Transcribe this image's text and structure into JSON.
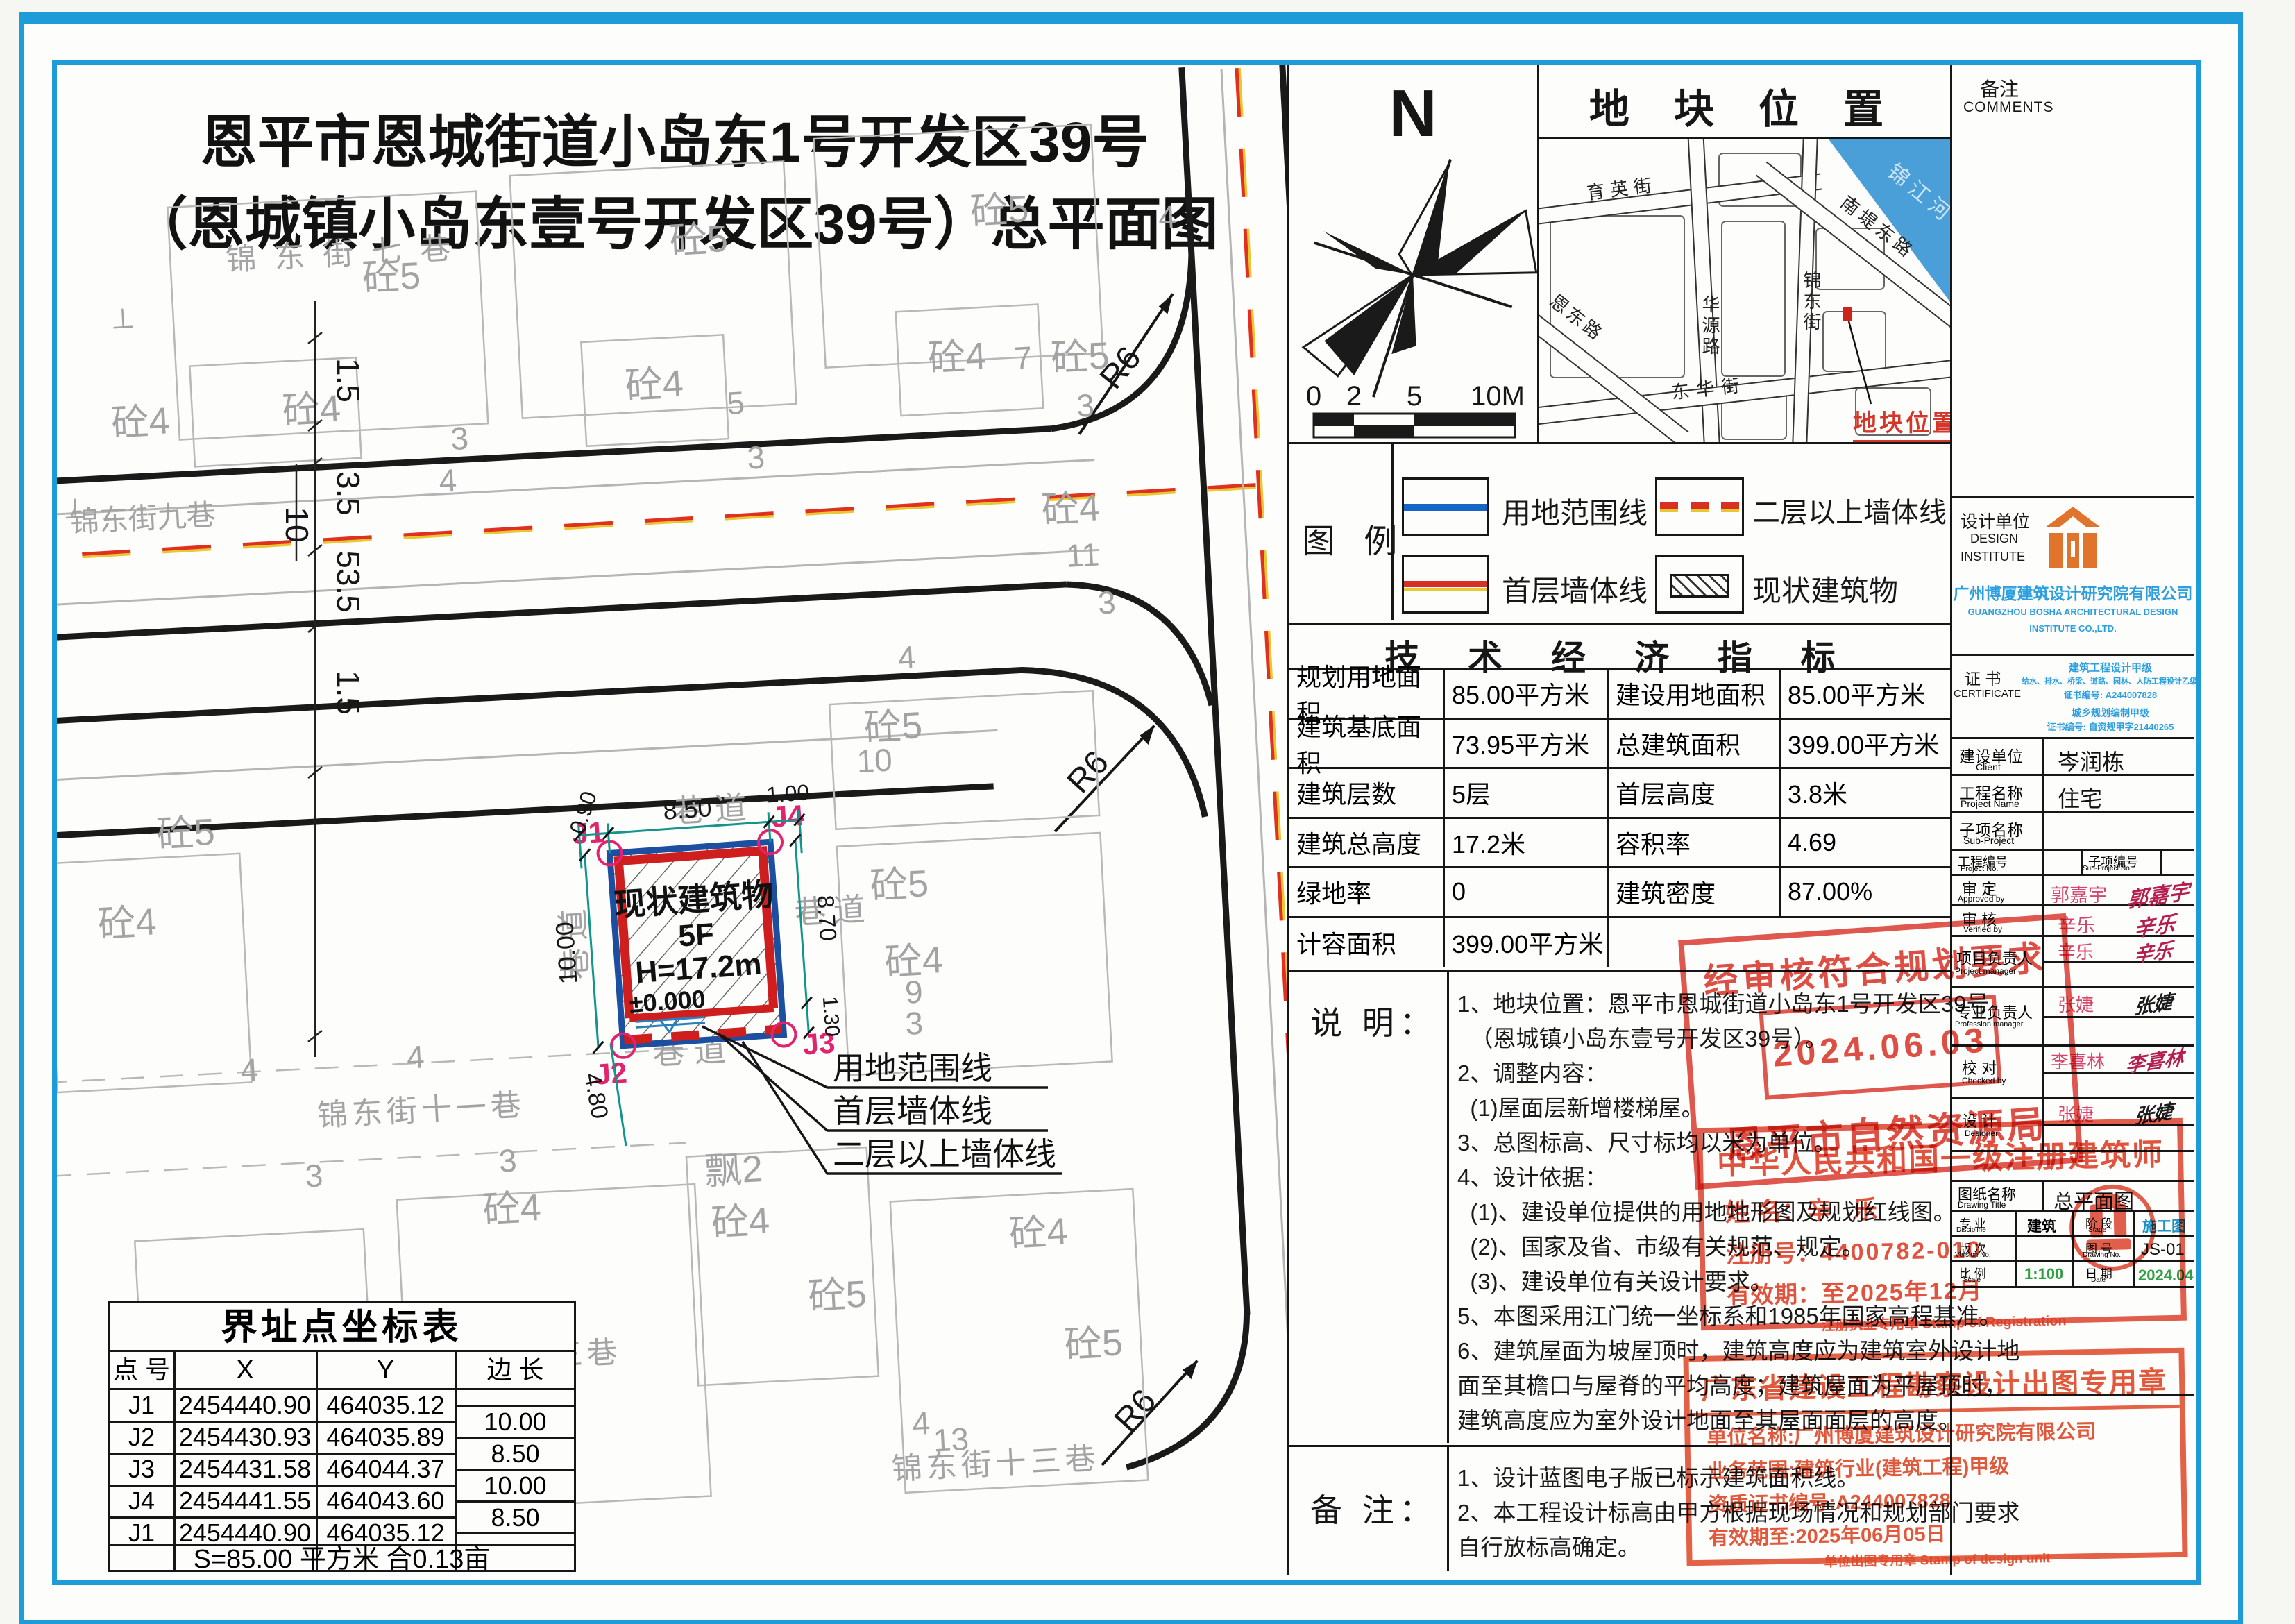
{
  "colors": {
    "frame_blue": "#1e9cd7",
    "stamp_red": "#d93025",
    "boundary_blue": "#1d4fa0",
    "wall_red": "#cf1e1e",
    "company_blue": "#2b9fe0",
    "logo_orange": "#e0742c",
    "dim_teal": "#12958a",
    "point_magenta": "#e0246e",
    "value_green": "#2f9e44",
    "stage_blue": "#1f8fc4"
  },
  "title": {
    "line1": "恩平市恩城街道小岛东1号开发区39号",
    "line2": "（恩城镇小岛东壹号开发区39号）总平面图"
  },
  "plan": {
    "streets": {
      "s7": "锦东街七巷",
      "s9": "锦东街九巷",
      "s11": "锦东街十一巷",
      "s13": "锦东街十三巷"
    },
    "t": {
      "lane": "巷道",
      "c5": "砼5",
      "c4": "砼4",
      "p2": "飘2",
      "n3": "3",
      "n4": "4",
      "n5": "5",
      "n7": "7",
      "n9": "9",
      "n10": "10",
      "n11": "11",
      "n13": "13",
      "r6": "R6",
      "perp": "⊥"
    },
    "building": {
      "name": "现状建筑物",
      "floors": "5F",
      "height": "H=17.2m",
      "level": "±0.000"
    },
    "pts": {
      "j1": "J1",
      "j2": "J2",
      "j3": "J3",
      "j4": "J4"
    },
    "dims": {
      "d090": "0.90",
      "d850": "8.50",
      "d100": "1.00",
      "d1000": "10.00",
      "d480": "4.80",
      "d870": "8.70",
      "d130": "1.30"
    },
    "chain": {
      "a": "1.5",
      "b": "3.5",
      "c": "10",
      "d": "53.5",
      "e": "1.5"
    },
    "leaders": {
      "l1": "用地范围线",
      "l2": "首层墙体线",
      "l3": "二层以上墙体线"
    }
  },
  "compass": {
    "n": "N",
    "s0": "0",
    "s2": "2",
    "s5": "5",
    "s10": "10M"
  },
  "map": {
    "title": "地 块 位 置",
    "river": "锦江河",
    "yuying": "育英街",
    "huayuan": "华源路",
    "endong": "恩东路",
    "donghua": "东华街",
    "jindong": "锦东街",
    "nandi": "南堤东路",
    "marker": "地块位置"
  },
  "legend": {
    "title": "图  例",
    "i1": "用地范围线",
    "i2": "二层以上墙体线",
    "i3": "首层墙体线",
    "i4": "现状建筑物"
  },
  "tech": {
    "title": "技 术 经 济 指 标",
    "rows": [
      [
        "规划用地面积",
        "85.00平方米",
        "建设用地面积",
        "85.00平方米"
      ],
      [
        "建筑基底面积",
        "73.95平方米",
        "总建筑面积",
        "399.00平方米"
      ],
      [
        "建筑层数",
        "5层",
        "首层高度",
        "3.8米"
      ],
      [
        "建筑总高度",
        "17.2米",
        "容积率",
        "4.69"
      ],
      [
        "绿地率",
        "0",
        "建筑密度",
        "87.00%"
      ]
    ],
    "last": [
      "计容面积",
      "399.00平方米"
    ]
  },
  "notes": {
    "label": "说 明：",
    "lines": [
      "1、地块位置：恩平市恩城街道小岛东1号开发区39号",
      "  （恩城镇小岛东壹号开发区39号）。",
      "2、调整内容：",
      "  (1)屋面层新增楼梯屋。",
      "3、总图标高、尺寸标均以米为单位。",
      "4、设计依据：",
      "  (1)、建设单位提供的用地地形图及规划红线图。",
      "  (2)、国家及省、市级有关规范、规定。",
      "  (3)、建设单位有关设计要求。",
      "5、本图采用江门统一坐标系和1985年国家高程基准。",
      "6、建筑屋面为坡屋顶时，建筑高度应为建筑室外设计地",
      "面至其檐口与屋脊的平均高度；建筑屋面为平屋顶时，",
      "建筑高度应为室外设计地面至其屋面面层的高度。"
    ]
  },
  "remarks": {
    "label": "备 注：",
    "lines": [
      "1、设计蓝图电子版已标示建筑面积线。",
      "2、本工程设计标高由甲方根据现场情况和规划部门要求",
      "自行放标高确定。"
    ]
  },
  "coord": {
    "title": "界址点坐标表",
    "h": [
      "点 号",
      "X",
      "Y",
      "边 长"
    ],
    "rows": [
      [
        "J1",
        "2454440.90",
        "464035.12"
      ],
      [
        "J2",
        "2454430.93",
        "464035.89"
      ],
      [
        "J3",
        "2454431.58",
        "464044.37"
      ],
      [
        "J4",
        "2454441.55",
        "464043.60"
      ],
      [
        "J1",
        "2454440.90",
        "464035.12"
      ]
    ],
    "edges": [
      "10.00",
      "8.50",
      "10.00",
      "8.50"
    ],
    "footer": "S=85.00 平方米 合0.13亩"
  },
  "tb": {
    "comments_zh": "备注",
    "comments_en": "COMMENTS",
    "di_zh": "设计单位",
    "di_en1": "DESIGN",
    "di_en2": "INSTITUTE",
    "company_zh": "广州博厦建筑设计研究院有限公司",
    "company_en1": "GUANGZHOU BOSHA ARCHITECTURAL DESIGN",
    "company_en2": "INSTITUTE CO.,LTD.",
    "cert_zh": "证 书",
    "cert_en": "CERTIFICATE",
    "cert1": "建筑工程设计甲级",
    "cert2": "给水、排水、桥梁、道路、园林、人防工程设计乙级",
    "cert3": "证书编号: A244007828",
    "cert4": "城乡规划编制甲级",
    "cert5": "证书编号: 自资规甲字21440265",
    "client_zh": "建设单位",
    "client_en": "Client",
    "client_v": "岑润栋",
    "proj_zh": "工程名称",
    "proj_en": "Project Name",
    "proj_v": "住宅",
    "sub_zh": "子项名称",
    "sub_en": "Sub-Project",
    "pno_zh": "工程编号",
    "pno_en": "Project No.",
    "sno_zh": "子项编号",
    "sno_en": "Sub-Project No.",
    "r1_zh": "审 定",
    "r1_en": "Approved by",
    "r1_v": "郭嘉宇",
    "r2_zh": "审 核",
    "r2_en": "Verified by",
    "r2_v": "辛乐",
    "r3_zh": "项目负责人",
    "r3_en": "Project manager",
    "r3_v": "辛乐",
    "r4_zh": "专业负责人",
    "r4_en": "Profession manager",
    "r4_v": "张婕",
    "r5_zh": "校 对",
    "r5_en": "Checked by",
    "r5_v": "李喜林",
    "r6_zh": "设 计",
    "r6_en": "Designer",
    "r6_v": "张婕",
    "dt_zh": "图纸名称",
    "dt_en": "Drawing Title",
    "dt_v": "总平面图",
    "disc_zh": "专 业",
    "disc_en": "Discipline",
    "disc_v": "建筑",
    "stage_zh": "阶 段",
    "stage_en": "Stage",
    "stage_v": "施工图",
    "ver_zh": "版 次",
    "ver_en": "Version No.",
    "no_zh": "图 号",
    "no_en": "Drawing No.",
    "no_v": "JS-01",
    "scale_zh": "比 例",
    "scale_en": "Scale",
    "scale_v": "1:100",
    "date_zh": "日 期",
    "date_en": "Date",
    "date_v": "2024.04"
  },
  "stamps": {
    "p_title": "经审核符合规划要求",
    "p_date": "2024.06.03",
    "p_org": "恩平市自然资源局",
    "a_title": "中华人民共和国一级注册建筑师",
    "a_name_l": "姓 名：",
    "a_name": "辛 乐",
    "a_reg_l": "注册号：",
    "a_reg": "4400782-010",
    "a_valid_l": "有效期：",
    "a_valid": "至2025年12月",
    "a_bottom": "注册执业专用章  Stamp of Registration",
    "d_title": "广东省建设工程勘察设计出图专用章",
    "d_l1": "单位名称:广州博厦建筑设计研究院有限公司",
    "d_l2": "业务范围:建筑行业(建筑工程)甲级",
    "d_l3": "资质证书编号:A244007828",
    "d_l4": "有效期至:2025年06月05日",
    "d_bottom": "单位出图专用章  Stamp of design unit"
  }
}
